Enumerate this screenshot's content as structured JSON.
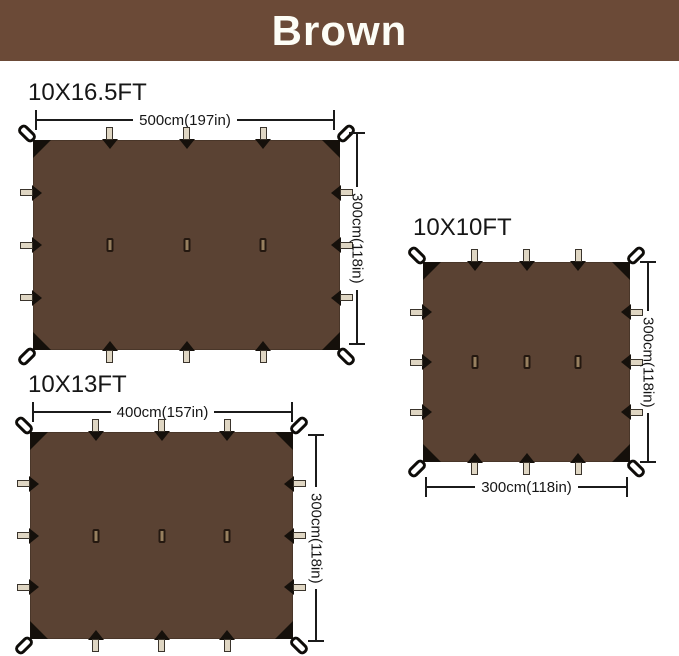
{
  "banner": {
    "label": "Brown"
  },
  "colors": {
    "banner_bg": "#6B4A37",
    "banner_text": "#FDFDF6",
    "tarp_fill": "#5A4233",
    "corner_patch": "#15100B",
    "tab_fill": "#DFD6C3",
    "slit_fill": "#97805F",
    "dimension_line": "#1B1B1B",
    "label_text": "#161616"
  },
  "tarps": [
    {
      "label": "10X16.5FT",
      "width_dim": "500cm(197in)",
      "height_dim": "300cm(118in)"
    },
    {
      "label": "10X13FT",
      "width_dim": "400cm(157in)",
      "height_dim": "300cm(118in)"
    },
    {
      "label": "10X10FT",
      "width_dim": "300cm(118in)",
      "height_dim": "300cm(118in)"
    }
  ]
}
